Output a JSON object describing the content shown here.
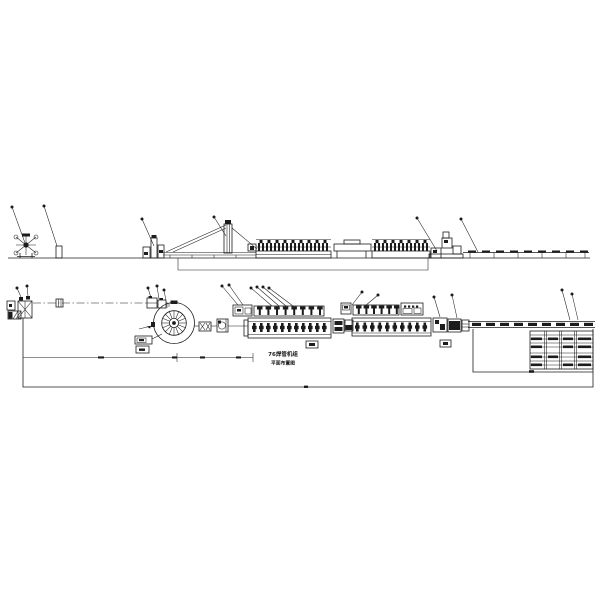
{
  "drawing": {
    "background": "#ffffff",
    "line_color": "#1c1c1c",
    "caption": {
      "line1": "76焊管机组",
      "line2": "平面布置图"
    }
  }
}
